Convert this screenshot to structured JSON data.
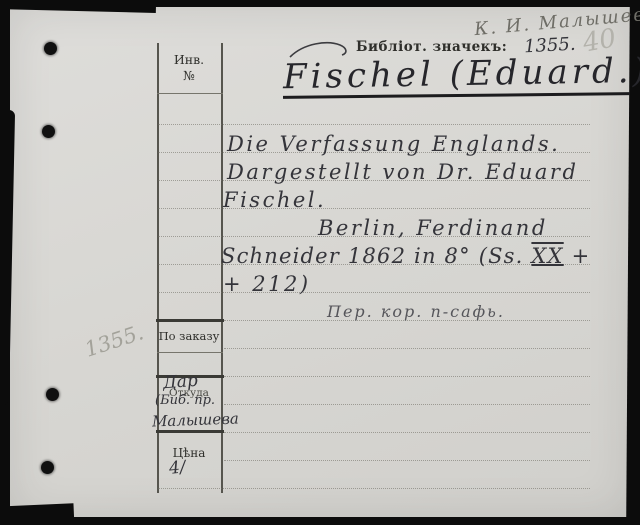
{
  "annotations": {
    "owner_signature": "К. И. Малышевъ",
    "page_number_pencil": "40",
    "margin_number_pencil": "1355."
  },
  "header": {
    "library_mark_label": "Библіот. значекъ:",
    "library_mark_number": "1355.",
    "author_heading": "Fischel (Eduard.)"
  },
  "entry": {
    "title_lines": [
      "Die Verfassung Englands.",
      "Dargestellt von Dr. Eduard",
      "Fischel."
    ],
    "imprint_line1": "Berlin, Ferdinand",
    "imprint_line2_prefix": "Schneider 1862 in 8° (Ss. ",
    "imprint_pages_roman": "XX",
    "imprint_line2_suffix": " +",
    "imprint_line3": "+ 212)",
    "binding_note": "Пер. кор. п-сафь."
  },
  "left_column": {
    "inventory_label_line1": "Инв.",
    "inventory_label_line2": "№",
    "order_label": "По заказу",
    "origin_label": "Откуда",
    "origin_handwriting_line1": "Дар",
    "origin_handwriting_line2": "(Биб. пр.",
    "origin_handwriting_line3": "Малышева",
    "price_label": "Цѣна",
    "price_value": "4/"
  },
  "colors": {
    "card_background": "#d8d7d3",
    "scan_border": "#0c0c0c",
    "ink": "#34343a",
    "pencil": "#a8a7a0",
    "rule_line": "#6e6c62"
  }
}
